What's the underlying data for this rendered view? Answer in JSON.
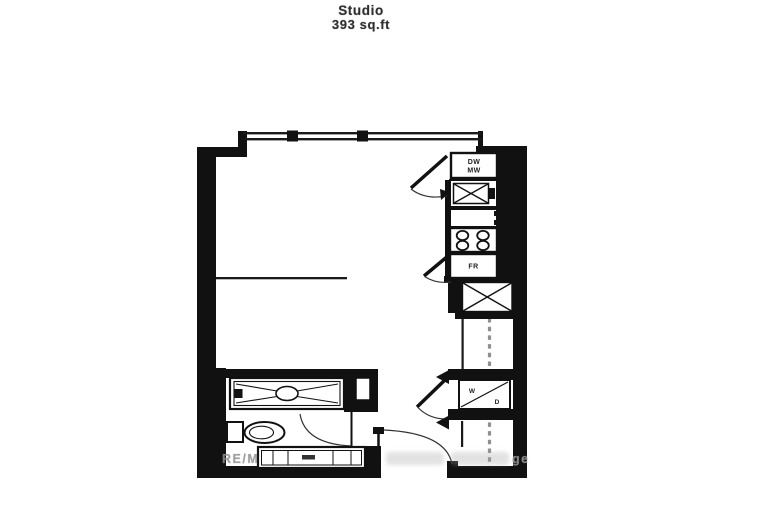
{
  "meta": {
    "document_type": "apartment floor plan",
    "unit_type": "Studio",
    "area_sqft": 393
  },
  "title": {
    "line1": "Studio",
    "line2": "393 sq.ft"
  },
  "floorplan": {
    "labels": {
      "dw": "DW",
      "mw": "MW",
      "fr": "FR",
      "w": "W",
      "d": "D"
    },
    "fixtures": [
      "dishwasher-microwave stack",
      "kitchen sink",
      "kitchen counter",
      "stove 4 burners",
      "fridge",
      "entry closet",
      "washer-dryer closet",
      "bathtub",
      "toilet",
      "vanity sink",
      "window wall",
      "entry door"
    ],
    "colors": {
      "wall": "#111111",
      "line": "#1a1a1a",
      "dashed_line": "#909090",
      "watermark": "#8f8f8f",
      "background": "#ffffff"
    }
  },
  "watermark": {
    "prefix": "RE/M",
    "suffix": "ge"
  }
}
